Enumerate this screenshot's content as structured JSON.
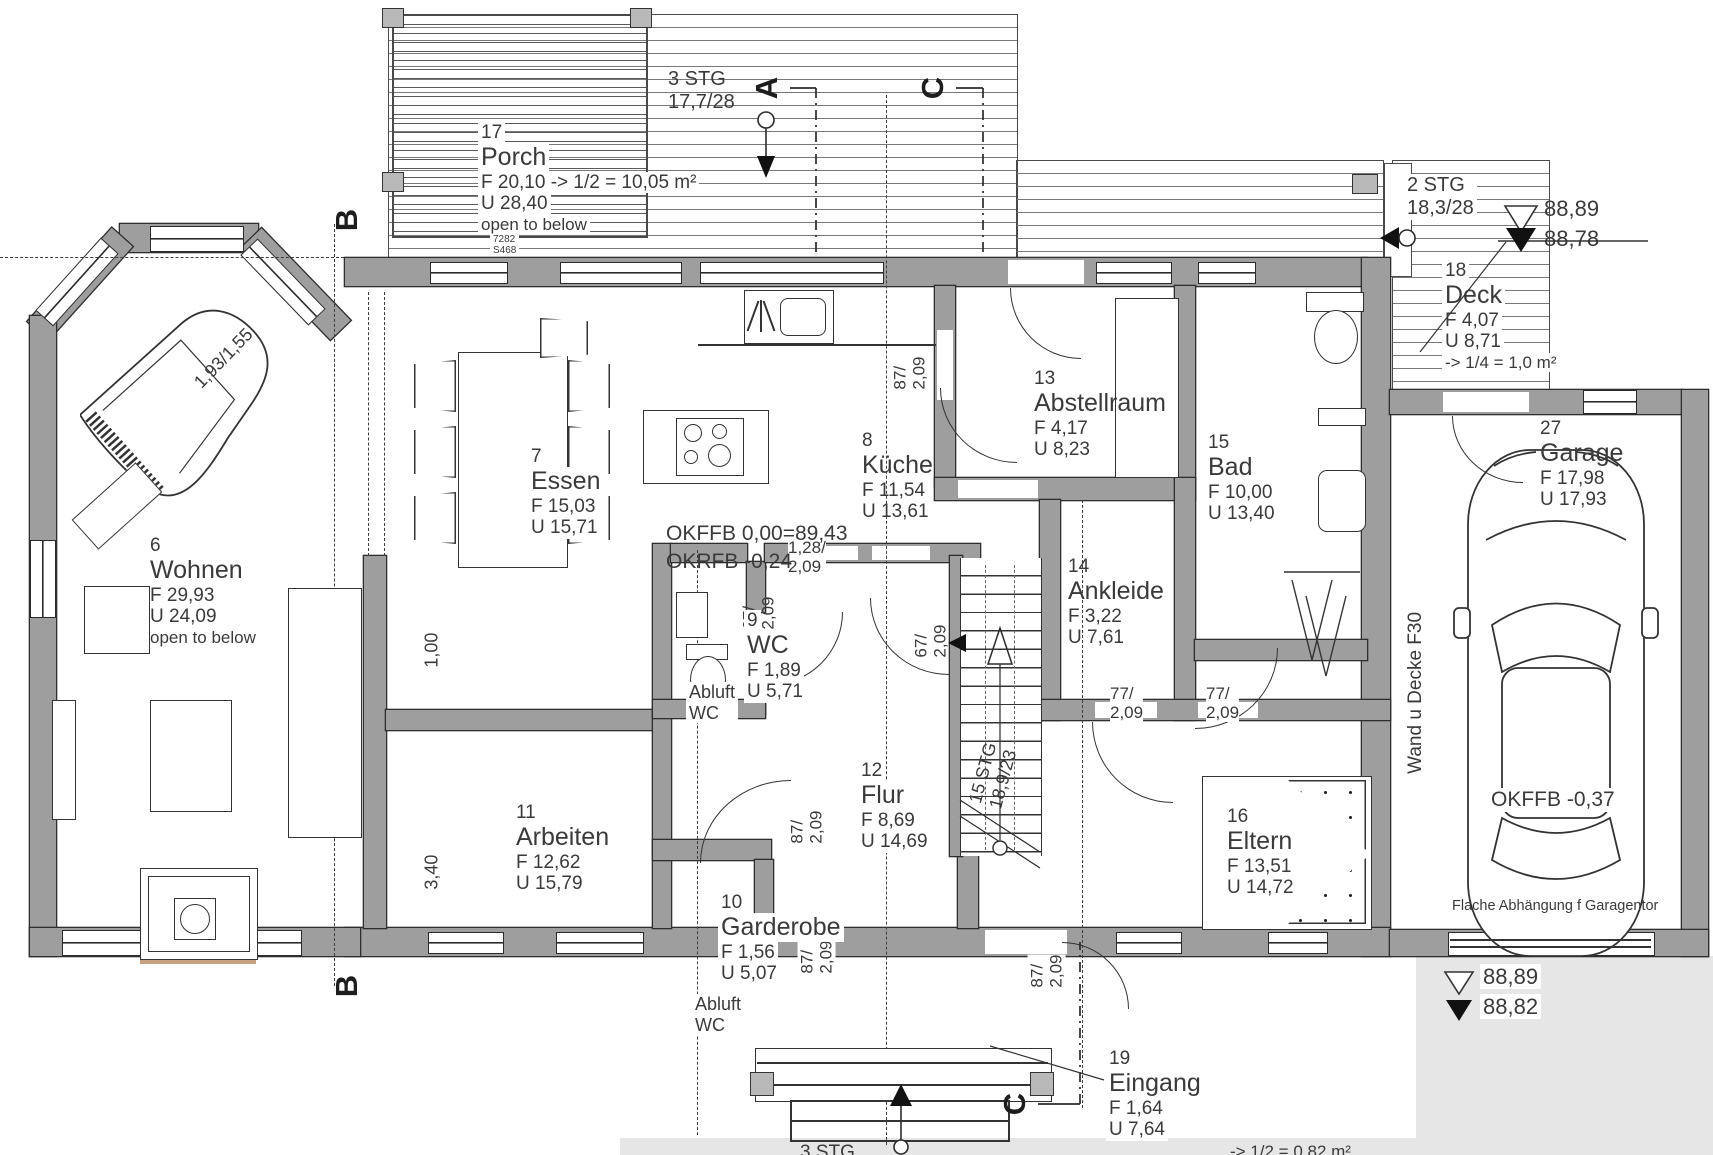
{
  "drawing": {
    "rooms": {
      "wohnen": {
        "no": "6",
        "name": "Wohnen",
        "f": "F 29,93",
        "u": "U 24,09",
        "extra": "open to below"
      },
      "essen": {
        "no": "7",
        "name": "Essen",
        "f": "F 15,03",
        "u": "U 15,71"
      },
      "kueche": {
        "no": "8",
        "name": "Küche",
        "f": "F 11,54",
        "u": "U 13,61"
      },
      "wc": {
        "no": "9",
        "name": "WC",
        "f": "F 1,89",
        "u": "U 5,71"
      },
      "garderobe": {
        "no": "10",
        "name": "Garderobe",
        "f": "F 1,56",
        "u": "U 5,07"
      },
      "arbeiten": {
        "no": "11",
        "name": "Arbeiten",
        "f": "F 12,62",
        "u": "U 15,79"
      },
      "flur": {
        "no": "12",
        "name": "Flur",
        "f": "F 8,69",
        "u": "U 14,69"
      },
      "abstellraum": {
        "no": "13",
        "name": "Abstellraum",
        "f": "F 4,17",
        "u": "U 8,23"
      },
      "ankleide": {
        "no": "14",
        "name": "Ankleide",
        "f": "F 3,22",
        "u": "U 7,61"
      },
      "bad": {
        "no": "15",
        "name": "Bad",
        "f": "F 10,00",
        "u": "U 13,40"
      },
      "eltern": {
        "no": "16",
        "name": "Eltern",
        "f": "F 13,51",
        "u": "U 14,72"
      },
      "porch": {
        "no": "17",
        "name": "Porch",
        "f": "F 20,10 -> 1/2 = 10,05 m²",
        "u": "U 28,40",
        "extra": "open to below"
      },
      "deck": {
        "no": "18",
        "name": "Deck",
        "f": "F 4,07",
        "u": "U 8,71",
        "extra": "-> 1/4 = 1,0 m²"
      },
      "eingang": {
        "no": "19",
        "name": "Eingang",
        "f": "F 1,64",
        "u": "U 7,64"
      },
      "garage": {
        "no": "27",
        "name": "Garage",
        "f": "F 17,98",
        "u": "U 17,93"
      }
    },
    "stairs": {
      "top": "3 STG\n17,7/28",
      "right": "2 STG\n18,3/28",
      "main": "15 STG\n18,9/23",
      "bottom": "3 STG",
      "bottom_area": "-> 1/2 = 0,82 m²"
    },
    "levels": {
      "tr_upper": "88,89",
      "tr_lower": "88,78",
      "br_upper": "88,89",
      "br_lower": "88,82"
    },
    "labels": {
      "okffb_main": "OKFFB   0,00=89,43",
      "okrfb_main": "OKRFB -0,24",
      "okffb_garage": "OKFFB -0,37",
      "wand_decke": "Wand u Decke F30",
      "garagentor": "Flache Abhängung f Garagentor",
      "abluft_wc": "Abluft\nWC",
      "piano_size": "1,93/1,55",
      "ref_no": "7282\nS468"
    },
    "dims": {
      "d87": "87/\n2,09",
      "d67": "67/\n2,09",
      "d77": "77/\n2,09",
      "d128": "1,28/\n2,09",
      "d100": "1,00",
      "d340": "3,40"
    },
    "sections": {
      "a": "A",
      "b": "B",
      "c": "C"
    },
    "colors": {
      "wall": "#9e9e9e",
      "line": "#333333",
      "drive": "#e6e6e6",
      "sill": "#c8a183"
    }
  }
}
